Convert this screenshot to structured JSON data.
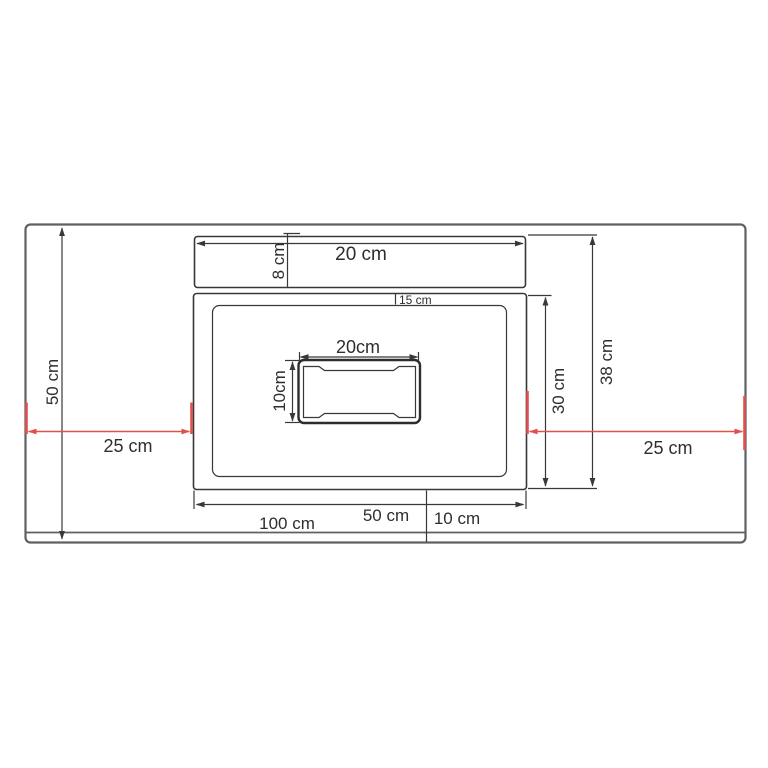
{
  "title": "sink-countertop-installation-drawing",
  "colors": {
    "bg": "#ffffff",
    "line": "#383838",
    "outline": "#5f6062",
    "text": "#2e2e2e",
    "red": "#e0514e"
  },
  "labels": {
    "counter_depth": "50 cm",
    "left_clearance": "25 cm",
    "right_clearance": "25 cm",
    "shelf_width": "20 cm",
    "shelf_depth": "8 cm",
    "basin_edge_offset": "15 cm",
    "cutout_width": "20cm",
    "cutout_depth": "10cm",
    "unit_depth": "30 cm",
    "overall_depth": "38 cm",
    "bottom_width_a": "100 cm",
    "bottom_width_b": "50 cm",
    "bottom_width_c": "10 cm"
  }
}
